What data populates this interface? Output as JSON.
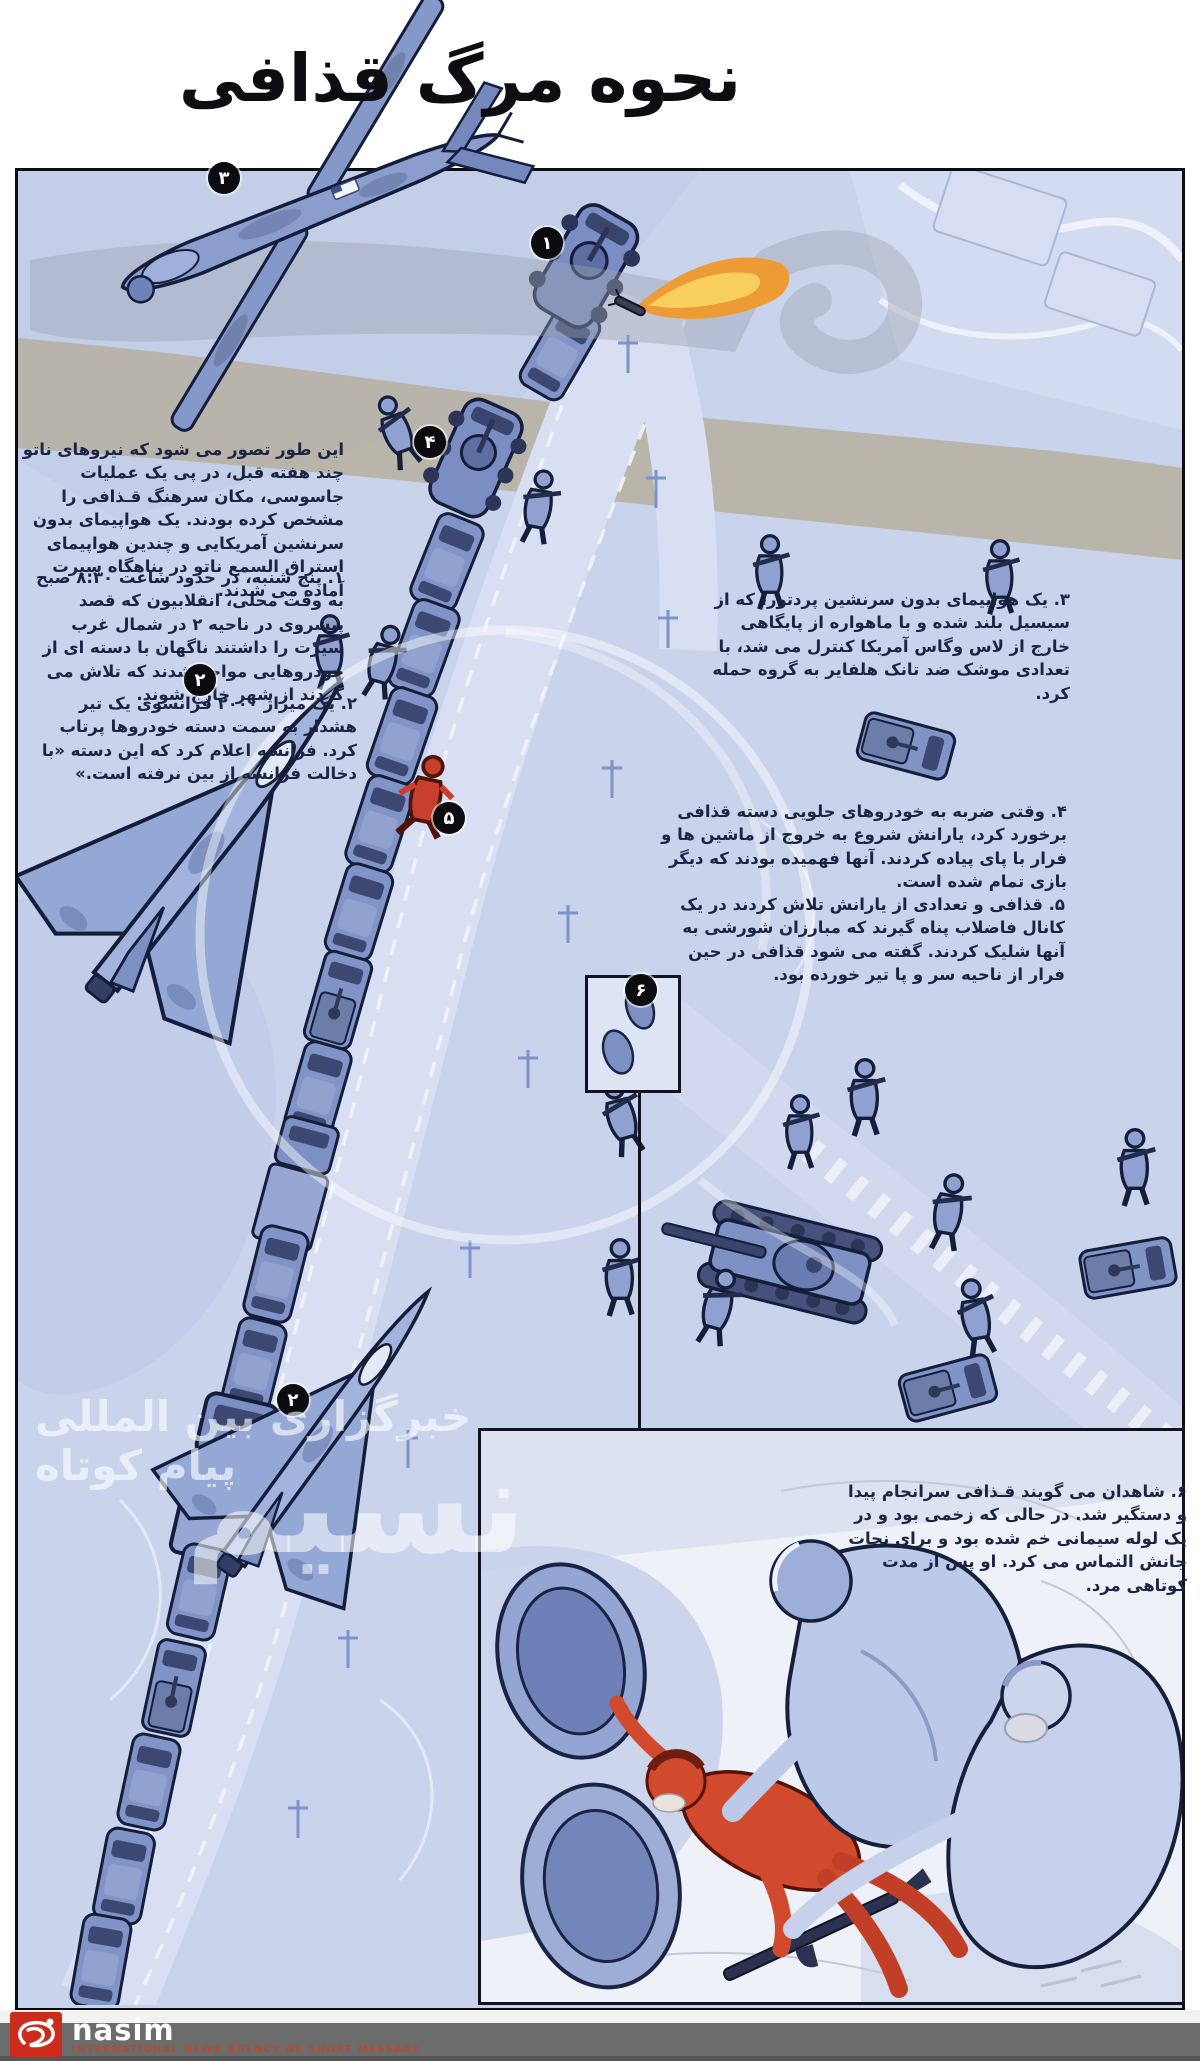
{
  "title": "نحوه مرگ قذافی",
  "intro": "این طور تصور می شود که نیروهای ناتو چند هفته قبل، در پی یک عملیات جاسوسی، مکان سرهنگ قـذافی را مشخص کرده بودند. یک هواپیمای بدون سرنشین آمریکایی و چندین هواپیمای استراق السمع ناتو در پناهگاه سیرت آماده می شدند.",
  "steps": [
    {
      "text": "۱. پنج شنبه، در حدود ساعت ۸:۳۰ صبح به وقت محلی، انقلابیون که قصد پیشروی در ناحیه ۲ در شمال غرب سیرت را داشتند ناگهان با دسته ای از خودروهایی مواجه شدند که تلاش می کردند از شهر خارج شوند."
    },
    {
      "text": "۲. یک میراژ ۲۰۰۰ فرانسوی یک تیر هشدار به سمت دسته خودروها پرتاب کرد. فرانسه اعلام کرد که این دسته «با دخالت فرانسه از بین نرفته است.»"
    },
    {
      "text": "۳. یک هواپیمای بدون سرنشین پردتور، که از سیسیل بلند شده و با ماهواره از پایگاهی خارج از لاس وگاس آمریکا کنترل می شد، با تعدادی موشک ضد تانک هلفایر به گروه حمله کرد."
    },
    {
      "text": "۴. وقتی ضربه به خودروهای جلویی دسته قذافی برخورد کرد، یارانش شروع به خروج از ماشین ها و فرار با پای پیاده کردند. آنها فهمیده بودند که دیگر بازی تمام شده است."
    },
    {
      "text": "۵. قذافی و تعدادی از یارانش تلاش کردند در یک کانال فاضلاب پناه گیرند که مبارزان شورشی به آنها شلیک کردند. گفته می شود قذافی در حین فرار از ناحیه سر و پا تیر خورده بود."
    },
    {
      "text": "۶. شاهدان می گویند قـذافی سرانجام پیدا و دستگیر شد. در حالی که زخمی بود و در یک لوله سیمانی خم شده بود و برای نجات جانش التماس می کرد. او پس از مدت کوتاهی مرد."
    }
  ],
  "badges": {
    "lead_vehicle": "۱",
    "jet": "۲",
    "drone": "۳",
    "apc": "۴",
    "runner": "۵",
    "culvert": "۶"
  },
  "watermark": {
    "line1": "خبرگزاری بین المللی پیام کوتاه",
    "line2": "نسیم"
  },
  "footer": {
    "brand": "nasim",
    "tagline": "INTERNATIONAL NEWS AGENCY OF SHORT MESSAGE"
  },
  "colors": {
    "terrain": "#c9d3ec",
    "road": "#d9dff2",
    "vehicle_blue": "#8094c8",
    "outline_navy": "#141d3a",
    "gaddafi_red": "#cf4a2e",
    "flame_orange": "#ec9b35",
    "text_navy": "#1b2442",
    "footer_gray": "#6c6c6c",
    "logo_red": "#cb2c1b"
  }
}
